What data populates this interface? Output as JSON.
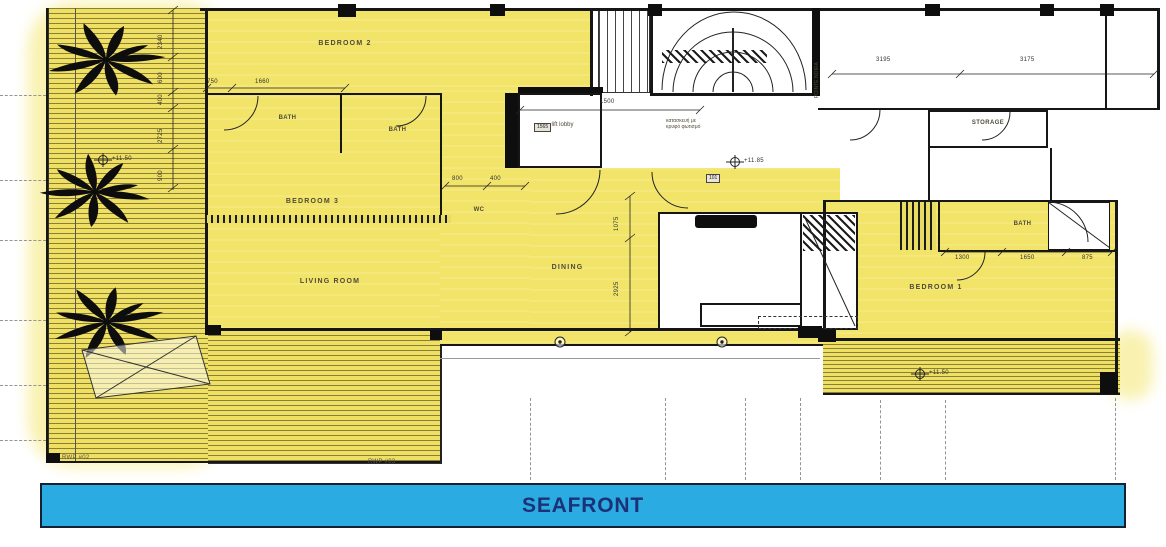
{
  "banner": {
    "label": "SEAFRONT",
    "bg": "#2AACE3",
    "text_color": "#1C3176"
  },
  "colors": {
    "plan_yellow": "#F2E468",
    "halo_yellow": "#F8EFA2",
    "wall": "#161616"
  },
  "rooms": {
    "bedroom2": "BEDROOM 2",
    "bedroom3": "BEDROOM 3",
    "bedroom1": "BEDROOM 1",
    "living_room": "LIVING ROOM",
    "dining": "DINING",
    "bath_left": "BATH",
    "bath_mid": "BATH",
    "bath_right": "BATH",
    "wc": "WC",
    "lift_lobby": "lift lobby",
    "storage": "STORAGE",
    "stairwell": "POINTE NOIRA",
    "note_greek_1": "κατασκευή με",
    "note_greek_2": "κρυφό φωτισμό"
  },
  "dimensions": {
    "top_750": "750",
    "top_1660": "1660",
    "lift_1500": "1500",
    "corridor_3195": "3195",
    "corridor_3175": "3175",
    "wc_800": "800",
    "wc_400": "400",
    "bed1_1300": "1300",
    "bed1_1650": "1650",
    "bed1_875": "875",
    "left_2340": "2340",
    "left_600": "600",
    "left_400": "400",
    "left_2725": "2725",
    "left_900": "900",
    "mid_1075": "1075",
    "mid_2925": "2925"
  },
  "tags": {
    "lift_1565": "1565",
    "room_101": "101"
  },
  "levels": {
    "terrace_left": "+11.50",
    "hall": "+11.85",
    "terrace_right": "+11.50"
  },
  "annotations": {
    "rwp_left": "RWP #02",
    "rwp_right": "RWP #03"
  }
}
